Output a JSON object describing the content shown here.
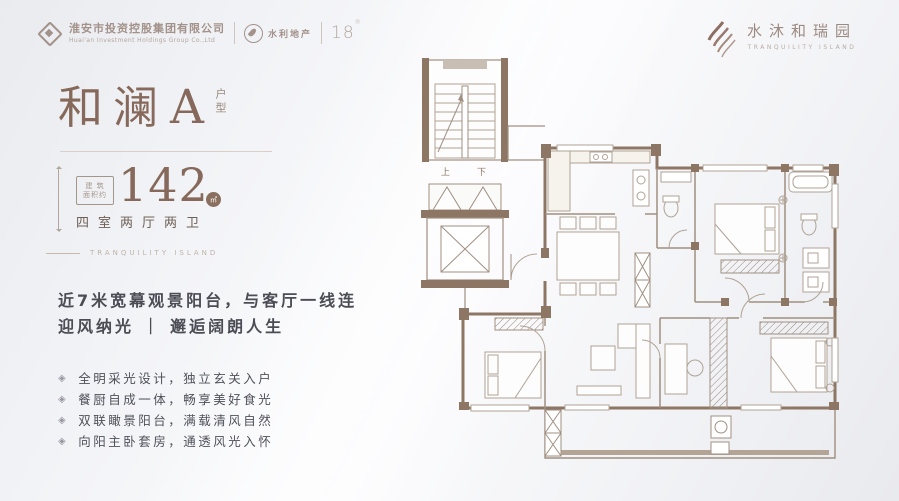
{
  "header": {
    "company": {
      "name": "淮安市投资控股集团有限公司",
      "name_en": "Huai'an Investment Holdings Group Co.,Ltd"
    },
    "partner": {
      "name": "水利地产"
    },
    "anniversary": "18",
    "anniversary_mark": "®",
    "brand": {
      "name": "水沐和瑞园",
      "name_en": "TRANQUILITY ISLAND"
    }
  },
  "unit": {
    "title": "和澜",
    "variant": "A",
    "type_label": "户型",
    "area_prefix_line1": "建 筑",
    "area_prefix_line2": "面积约",
    "area_value": "142",
    "area_unit": "㎡",
    "rooms": "四室两厅两卫",
    "caption": "TRANQUILITY ISLAND",
    "tagline1": "近7米宽幕观景阳台，与客厅一线连",
    "tagline2": "迎风纳光 ｜ 邂逅阔朗人生",
    "bullet_icon": "◈",
    "features": [
      "全明采光设计，独立玄关入户",
      "餐厨自成一体，畅享美好食光",
      "双联瞰景阳台，满载清风自然",
      "向阳主卧套房，通透风光入怀"
    ]
  },
  "floorplan": {
    "stair_up": "上",
    "stair_down": "下"
  },
  "colors": {
    "accent": "#86695a",
    "wall": "#8d7663",
    "line": "#a08f80",
    "text_dark": "#4c4c55"
  }
}
